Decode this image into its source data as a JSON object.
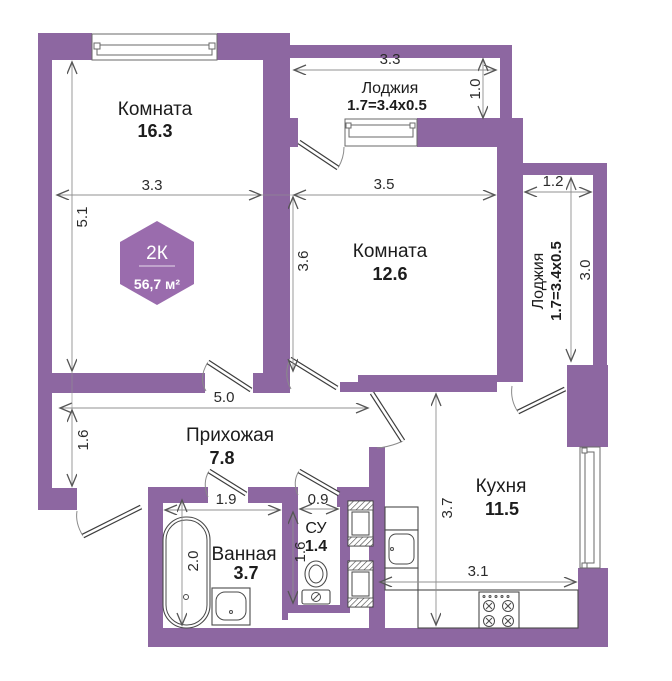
{
  "colors": {
    "wall": "#8d67a1",
    "badge": "#9a6cad",
    "dim_line": "#909090",
    "dim_text": "#2b2b2b",
    "label_text": "#1c1c1c",
    "fixture": "#4a4a4a"
  },
  "badge": {
    "rooms_type": "2К",
    "total_area": "56,7 м²"
  },
  "rooms": {
    "room1": {
      "name": "Комната",
      "area": "16.3"
    },
    "loggia_top": {
      "name": "Лоджия",
      "size": "1.7=3.4x0.5"
    },
    "room2": {
      "name": "Комната",
      "area": "12.6"
    },
    "loggia_right": {
      "name": "Лоджия",
      "size": "1.7=3.4x0.5"
    },
    "hallway": {
      "name": "Прихожая",
      "area": "7.8"
    },
    "bathroom": {
      "name": "Ванная",
      "area": "3.7"
    },
    "wc": {
      "name": "СУ",
      "area": "1.4"
    },
    "kitchen": {
      "name": "Кухня",
      "area": "11.5"
    }
  },
  "dims": {
    "room1_width": "3.3",
    "room1_height": "5.1",
    "loggia_top_width": "3.3",
    "loggia_top_depth": "1.0",
    "room2_width": "3.5",
    "room2_height": "3.6",
    "loggia_right_width": "1.2",
    "loggia_right_height": "3.0",
    "hallway_width": "5.0",
    "hallway_height": "1.6",
    "bathroom_width": "1.9",
    "bathtub_length": "2.0",
    "wc_width": "0.9",
    "wc_height": "1.6",
    "kitchen_height": "3.7",
    "kitchen_width": "3.1"
  }
}
